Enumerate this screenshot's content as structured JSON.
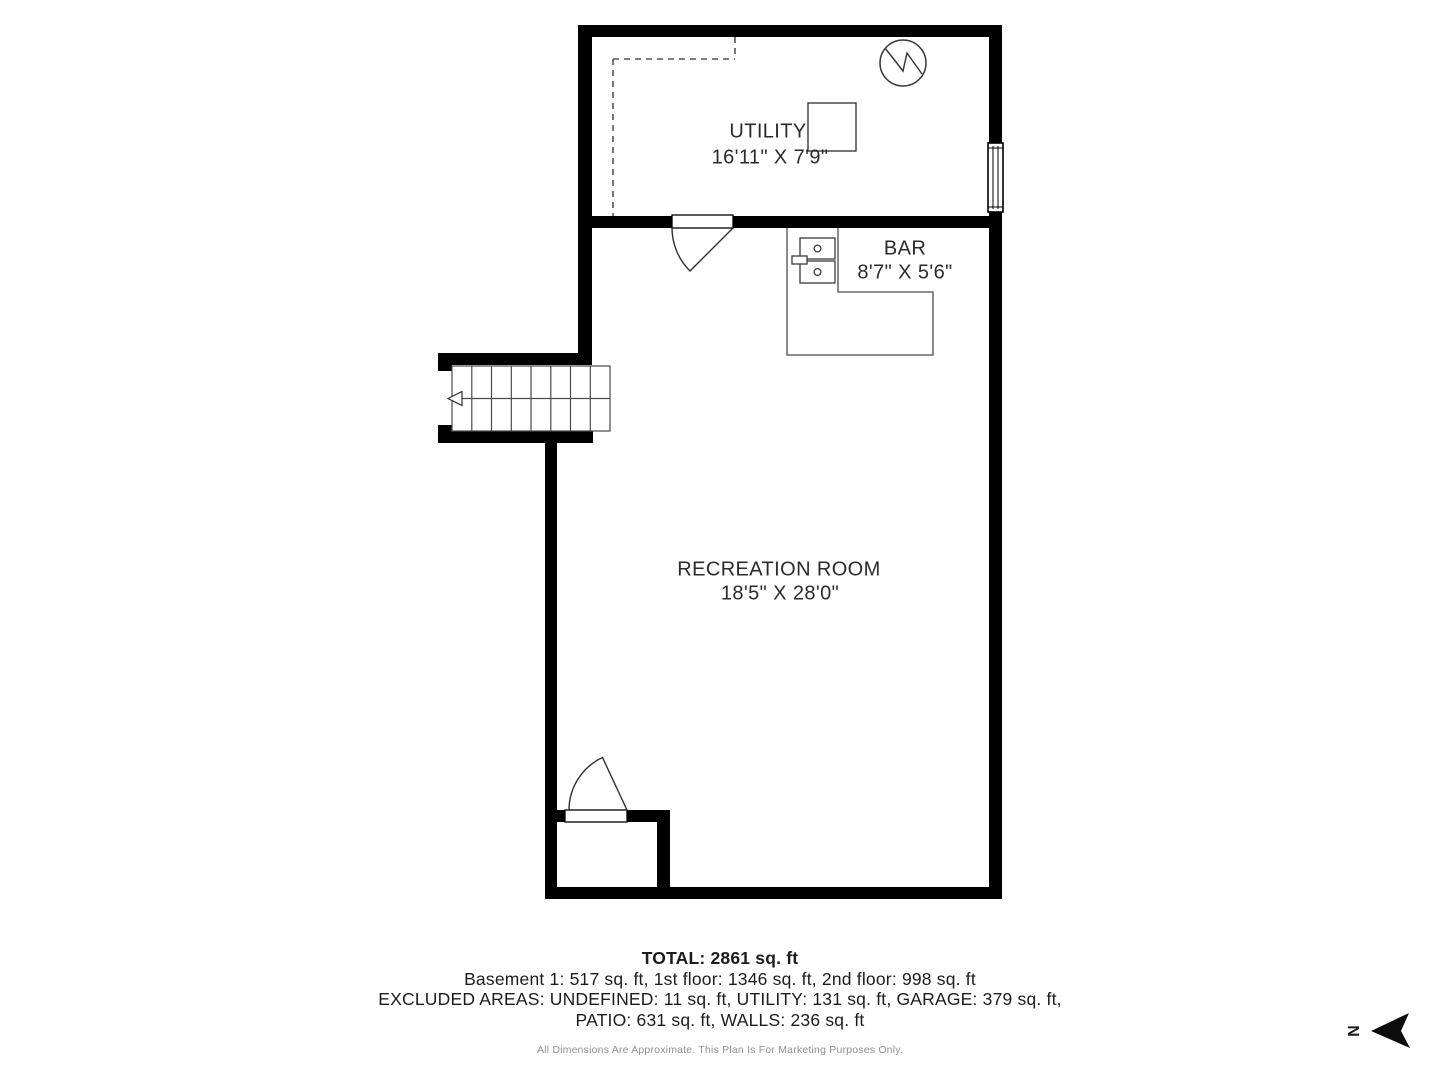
{
  "plan": {
    "rooms": [
      {
        "name": "UTILITY",
        "dims": "16'11\" X 7'9\""
      },
      {
        "name": "BAR",
        "dims": "8'7\" X 5'6\""
      },
      {
        "name": "RECREATION ROOM",
        "dims": "18'5\" X 28'0\""
      }
    ],
    "summary": {
      "total": "TOTAL: 2861 sq. ft",
      "floors": "Basement 1: 517 sq. ft, 1st floor: 1346 sq. ft, 2nd floor: 998 sq. ft",
      "excluded_line1": "EXCLUDED AREAS: UNDEFINED: 11 sq. ft, UTILITY: 131 sq. ft, GARAGE: 379 sq. ft,",
      "excluded_line2": "PATIO: 631 sq. ft, WALLS: 236 sq. ft",
      "disclaimer": "All Dimensions Are Approximate. This Plan Is For Marketing Purposes Only."
    },
    "compass": {
      "label": "N"
    },
    "colors": {
      "wall": "#000000",
      "fixture_stroke": "#3a3a3a",
      "dashed_line": "#555555",
      "label_text": "#2b2b2b",
      "muted_text": "#8f8f8f"
    }
  }
}
